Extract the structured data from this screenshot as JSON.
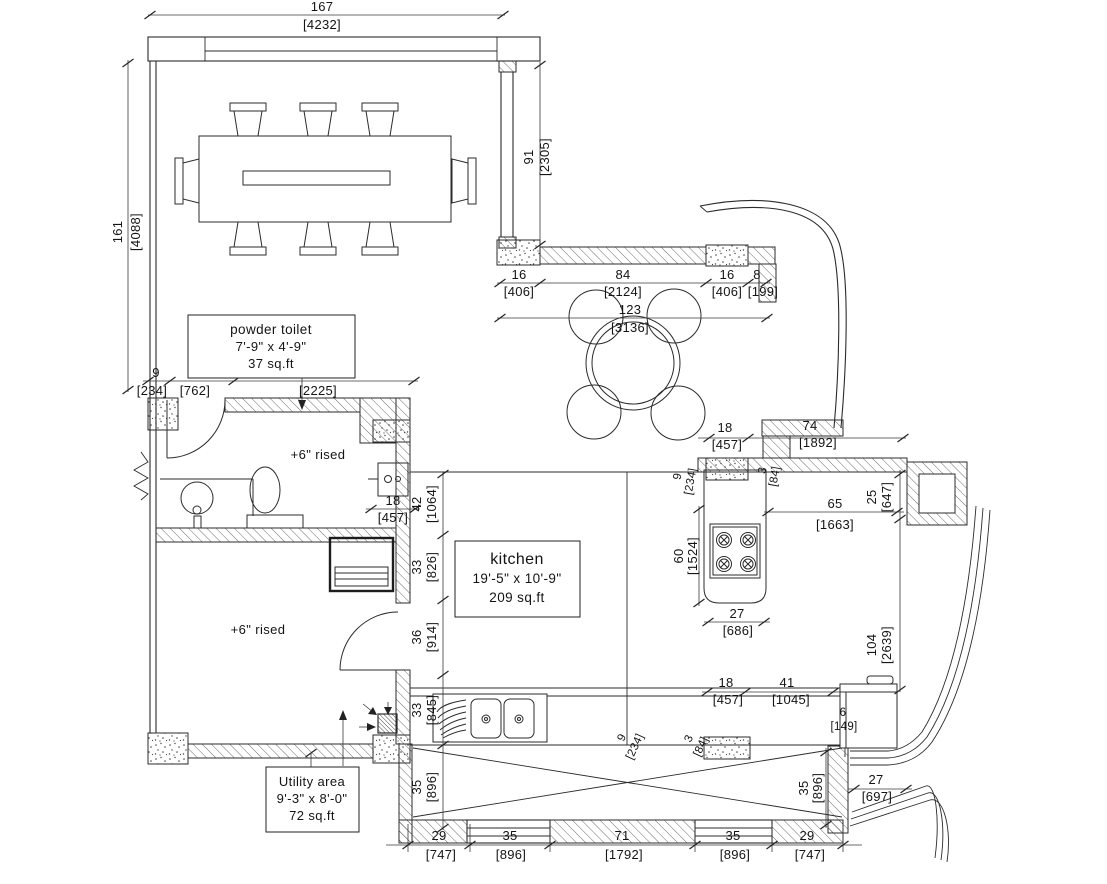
{
  "colors": {
    "line": "#2b2b2b",
    "background": "#ffffff",
    "text": "#141414"
  },
  "labels": {
    "powder_toilet": {
      "name": "powder toilet",
      "size": "7'-9\" x 4'-9\"",
      "area": "37 sq.ft"
    },
    "kitchen": {
      "name": "kitchen",
      "size": "19'-5\" x 10'-9\"",
      "area": "209 sq.ft"
    },
    "utility": {
      "name": "Utility area",
      "size": "9'-3\" x 8'-0\"",
      "area": "72 sq.ft"
    },
    "raised_top": "+6\" rised",
    "raised_bottom": "+6\" rised"
  },
  "dims": {
    "top_width": {
      "v": "167",
      "mm": "[4232]"
    },
    "left_height": {
      "v": "161",
      "mm": "[4088]"
    },
    "corridor": {
      "v": "91",
      "mm": "[2305]"
    },
    "nook_left": {
      "v": "16",
      "mm": "[406]"
    },
    "nook_table": {
      "v": "84",
      "mm": "[2124]"
    },
    "nook_right": {
      "v": "16",
      "mm": "[406]"
    },
    "nook_wall": {
      "v": "8",
      "mm": "[199]"
    },
    "nook_total": {
      "v": "123",
      "mm": "[3136]"
    },
    "pt_seg1": {
      "v": "9",
      "mm": "[234]"
    },
    "pt_seg2": {
      "v": "30",
      "mm": "[762]"
    },
    "pt_seg3": {
      "v": "88",
      "mm": "[2225]"
    },
    "pt_fixture": {
      "v": "18",
      "mm": "[457]"
    },
    "nook_below": {
      "v": "18",
      "mm": "[457]"
    },
    "wall_74": {
      "v": "74",
      "mm": "[1892]"
    },
    "k_seg_42": {
      "v": "42",
      "mm": "[1064]"
    },
    "k_seg_33a": {
      "v": "33",
      "mm": "[826]"
    },
    "k_seg_36": {
      "v": "36",
      "mm": "[914]"
    },
    "k_seg_33b": {
      "v": "33",
      "mm": "[845]"
    },
    "k_seg_35": {
      "v": "35",
      "mm": "[896]"
    },
    "island_len": {
      "v": "60",
      "mm": "[1524]"
    },
    "island_width": {
      "v": "27",
      "mm": "[686]"
    },
    "counter_65": {
      "v": "65",
      "mm": "[1663]"
    },
    "wall_25": {
      "v": "25",
      "mm": "[647]"
    },
    "wall_104": {
      "v": "104",
      "mm": "[2639]"
    },
    "r_seg_9": {
      "v": "9",
      "mm": "[234]"
    },
    "r_seg_3": {
      "v": "3",
      "mm": "[84]"
    },
    "b_seg_18": {
      "v": "18",
      "mm": "[457]"
    },
    "b_seg_41": {
      "v": "41",
      "mm": "[1045]"
    },
    "b_seg_6": {
      "v": "6",
      "mm": "[149]"
    },
    "b_seg_9": {
      "v": "9",
      "mm": "[234]"
    },
    "b_seg_3": {
      "v": "3",
      "mm": "[84]"
    },
    "deck_35_right": {
      "v": "35",
      "mm": "[896]"
    },
    "deck_27": {
      "v": "27",
      "mm": "[697]"
    },
    "bot_29a": {
      "v": "29",
      "mm": "[747]"
    },
    "bot_35a": {
      "v": "35",
      "mm": "[896]"
    },
    "bot_71": {
      "v": "71",
      "mm": "[1792]"
    },
    "bot_35b": {
      "v": "35",
      "mm": "[896]"
    },
    "bot_29b": {
      "v": "29",
      "mm": "[747]"
    }
  }
}
